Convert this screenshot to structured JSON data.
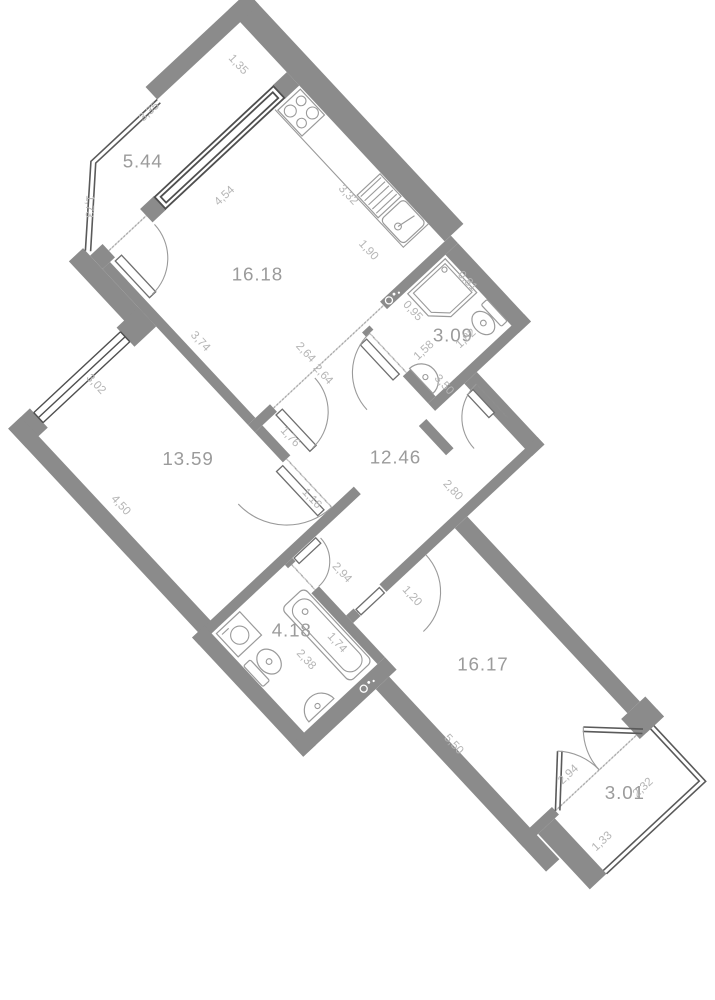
{
  "plan_title": "apartment floor plan",
  "areas": {
    "balcony_top": "5.44",
    "kitchen": "16.18",
    "bath_small": "3.09",
    "bedroom": "13.59",
    "hallway": "12.46",
    "bathroom": "4.18",
    "living": "16.17",
    "balcony_bottom": "3.01"
  },
  "dims": {
    "d135": "1,35",
    "d335": "3,35",
    "d173": "1,73",
    "d454": "4,54",
    "d332": "3,32",
    "d190": "1,90",
    "d374": "3,74",
    "d302": "3,02",
    "d450": "4,50",
    "d264a": "2,64",
    "d264b": "2,64",
    "d095": "0,95",
    "d081": "0,81",
    "d158": "1,58",
    "d182": "1,82",
    "d350": "3,50",
    "d176": "1,76",
    "d116": "1,16",
    "d280": "2,80",
    "d120": "1,20",
    "d294a": "2,94",
    "d238": "2,38",
    "d174": "1,74",
    "d550": "5,50",
    "d294b": "2,94",
    "d133": "1,33",
    "d232": "2,32"
  },
  "colors": {
    "wall": "#8b8b8b",
    "area_text": "#9b9b9b",
    "dim_text": "#b5b5b5",
    "background": "#ffffff"
  }
}
